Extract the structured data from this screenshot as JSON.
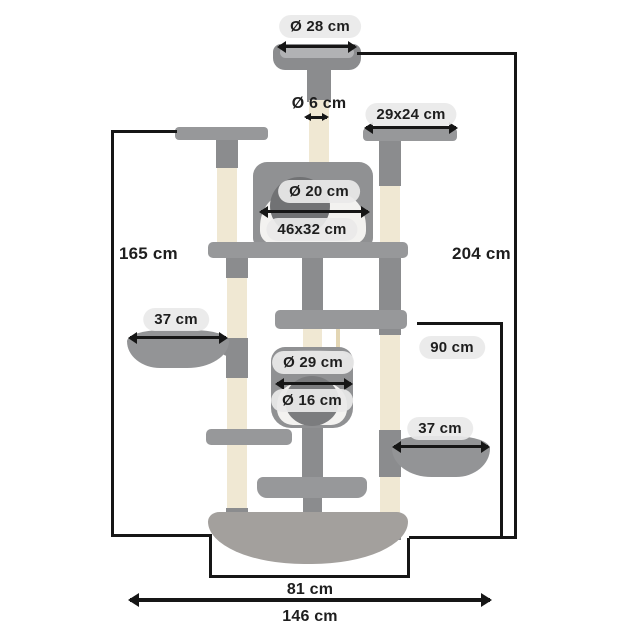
{
  "diagram": {
    "subject": "cat tree dimensions",
    "colors": {
      "plush_gray": "#97989a",
      "plush_dark": "#8b8c8e",
      "sisal_beige": "#f0e8d3",
      "white_inlay": "#f3f2f0",
      "hole_gray": "#717274",
      "base_gray": "#a3a09d",
      "badge_bg": "#eaeaea",
      "text": "#1e1e1e",
      "line": "#161616"
    }
  },
  "labels": {
    "top_bed_diameter": "Ø 28 cm",
    "pole_diameter": "Ø 6 cm",
    "top_platform_size": "29x24 cm",
    "condo_hole_diameter": "Ø 20 cm",
    "condo_size": "46x32 cm",
    "height_left": "165 cm",
    "height_total": "204 cm",
    "hammock_left_width": "37 cm",
    "height_right_lower": "90 cm",
    "barrel_diameter": "Ø 29 cm",
    "barrel_hole_diameter": "Ø 16 cm",
    "hammock_right_width": "37 cm",
    "base_width": "81 cm",
    "total_width": "146 cm"
  }
}
